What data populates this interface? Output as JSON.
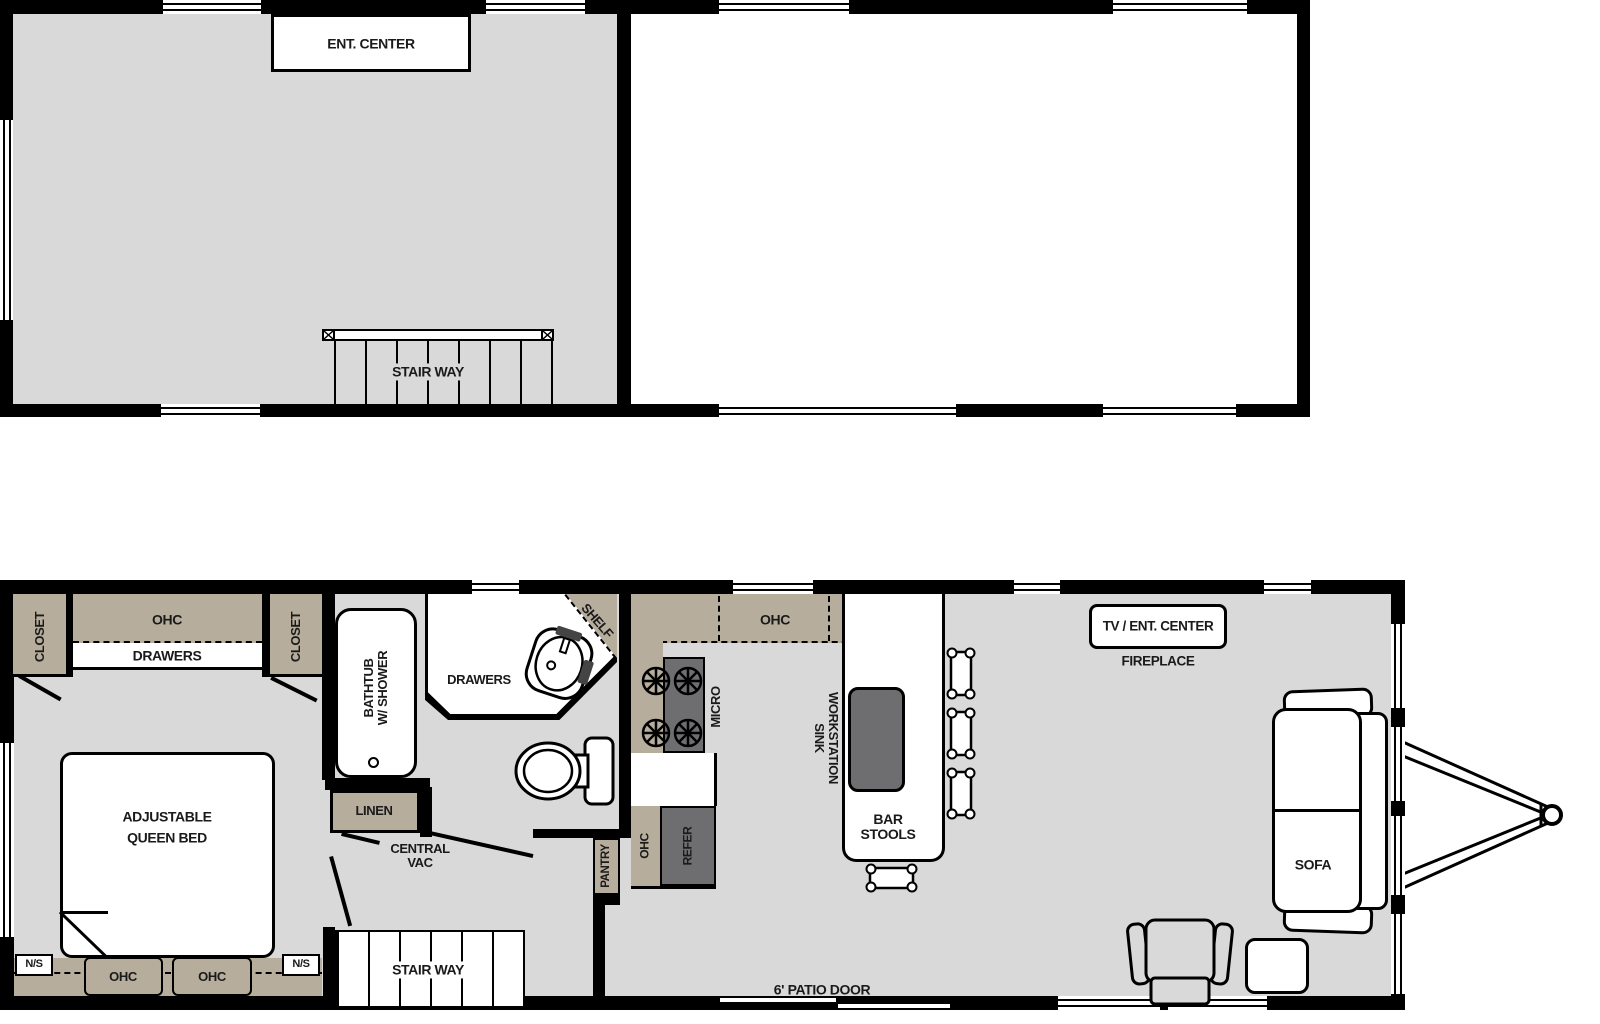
{
  "title": "Park model travel trailer two-level floor plan",
  "colors": {
    "wall": "#000000",
    "floor": "#d9d9d9",
    "cabinet_tan": "#b7ad9c",
    "appliance_gray": "#6e6e70",
    "background": "#ffffff"
  },
  "upper_floor": {
    "ent_center": "ENT. CENTER",
    "stairway": "STAIR WAY"
  },
  "bedroom": {
    "closet_left": "CLOSET",
    "closet_right": "CLOSET",
    "ohc": "OHC",
    "drawers": "DRAWERS",
    "bed_line1": "ADJUSTABLE",
    "bed_line2": "QUEEN BED",
    "ns_left": "N/S",
    "ns_right": "N/S",
    "ohc_cab1": "OHC",
    "ohc_cab2": "OHC"
  },
  "bathroom": {
    "bathtub_line1": "BATHTUB",
    "bathtub_line2": "W/ SHOWER",
    "drawers": "DRAWERS",
    "shelf": "SHELF",
    "linen": "LINEN",
    "central_vac_line1": "CENTRAL",
    "central_vac_line2": "VAC"
  },
  "kitchen": {
    "pantry": "PANTRY",
    "micro": "MICRO",
    "ohc_top": "OHC",
    "ohc_side": "OHC",
    "refer": "REFER",
    "workstation_line1": "WORKSTATION",
    "workstation_line2": "SINK",
    "bar_stools_line1": "BAR",
    "bar_stools_line2": "STOOLS"
  },
  "living": {
    "tv_ent_center": "TV / ENT. CENTER",
    "fireplace": "FIREPLACE",
    "sofa": "SOFA",
    "patio_door": "6' PATIO DOOR"
  },
  "lower_stairway": "STAIR WAY"
}
